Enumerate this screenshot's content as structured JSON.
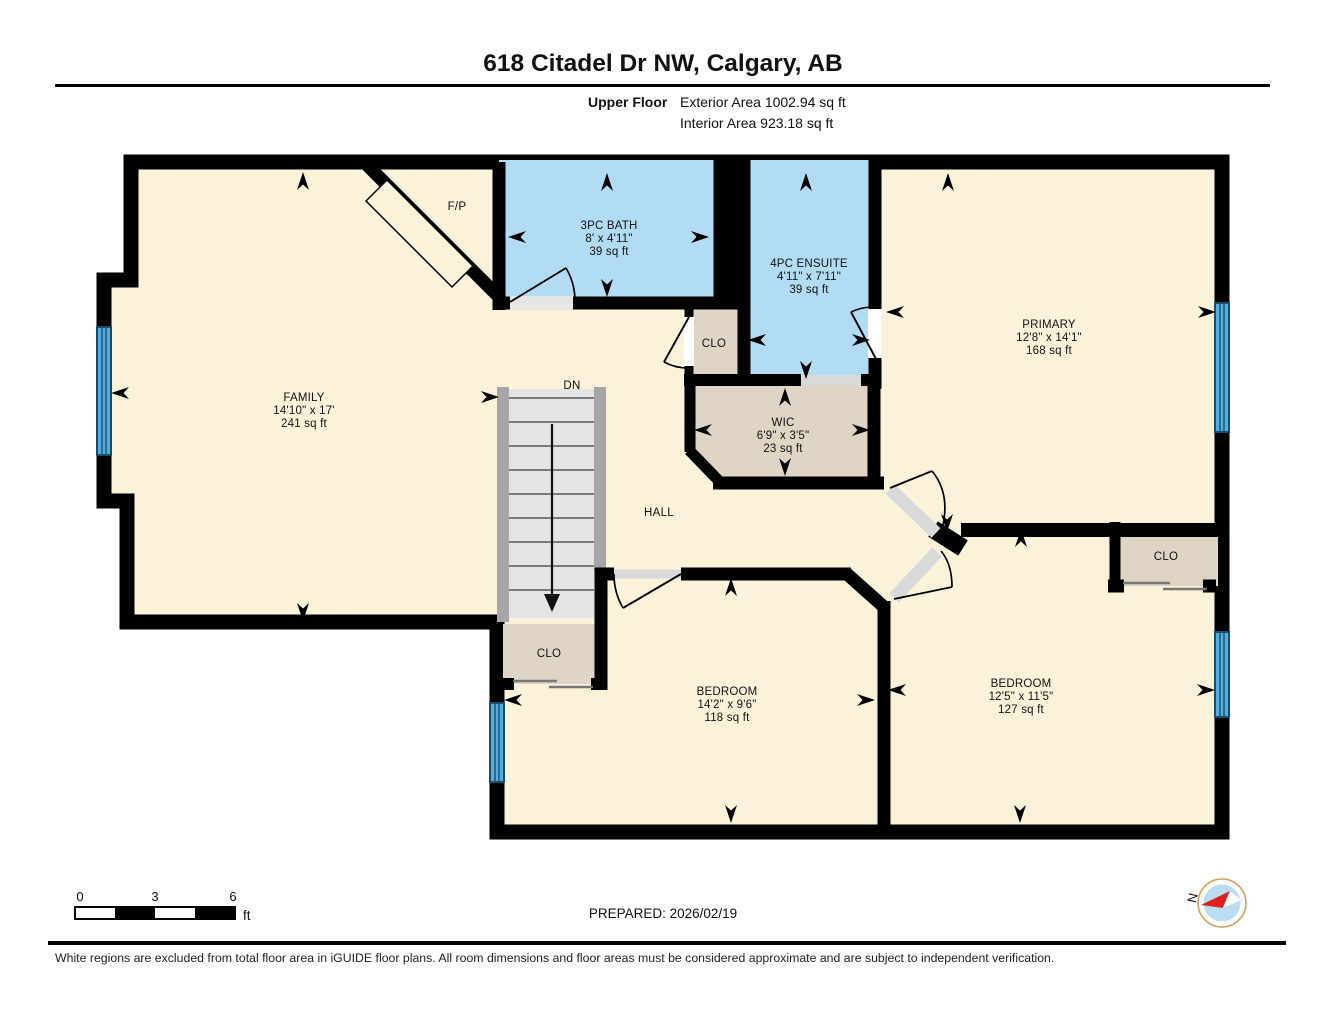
{
  "header": {
    "title": "618 Citadel Dr NW, Calgary, AB",
    "floor_label": "Upper Floor",
    "exterior_area": "Exterior Area 1002.94 sq ft",
    "interior_area": "Interior Area 923.18 sq ft"
  },
  "rooms": {
    "family": {
      "name": "FAMILY",
      "dims": "14'10\" x 17'",
      "area": "241 sq ft"
    },
    "bath": {
      "name": "3PC BATH",
      "dims": "8' x 4'11\"",
      "area": "39 sq ft"
    },
    "ensuite": {
      "name": "4PC ENSUITE",
      "dims": "4'11\" x 7'11\"",
      "area": "39 sq ft"
    },
    "primary": {
      "name": "PRIMARY",
      "dims": "12'8\" x 14'1\"",
      "area": "168 sq ft"
    },
    "wic": {
      "name": "WIC",
      "dims": "6'9\" x 3'5\"",
      "area": "23 sq ft"
    },
    "hall": {
      "name": "HALL"
    },
    "bedroom_left": {
      "name": "BEDROOM",
      "dims": "14'2\" x 9'6\"",
      "area": "118 sq ft"
    },
    "bedroom_right": {
      "name": "BEDROOM",
      "dims": "12'5\" x 11'5\"",
      "area": "127 sq ft"
    },
    "closet_mid": {
      "name": "CLO"
    },
    "closet_stairs": {
      "name": "CLO"
    },
    "closet_bedroom": {
      "name": "CLO"
    },
    "fireplace": {
      "name": "F/P"
    },
    "stairs": {
      "name": "DN"
    }
  },
  "footer": {
    "scale": {
      "t0": "0",
      "t3": "3",
      "t6": "6",
      "unit": "ft"
    },
    "prepared": "PREPARED: 2026/02/19",
    "compass_north": "N",
    "disclaimer": "White regions are excluded from total floor area in iGUIDE floor plans. All room dimensions and floor areas must be considered approximate and are subject to independent verification."
  },
  "colors": {
    "wall": "#000000",
    "floor": "#FAF3DA",
    "wet_room": "#B2DCF4",
    "closet": "#DFD5C5",
    "window": "#57ACDE",
    "window_line": "#14506E",
    "stair_tread": "#E4E4E4",
    "stair_wall": "#A6A6A6",
    "door_gap": "#D9D9D9",
    "compass_ring": "#D2A05A",
    "compass_face": "#BBDDF1",
    "compass_needle": "#E02020"
  }
}
